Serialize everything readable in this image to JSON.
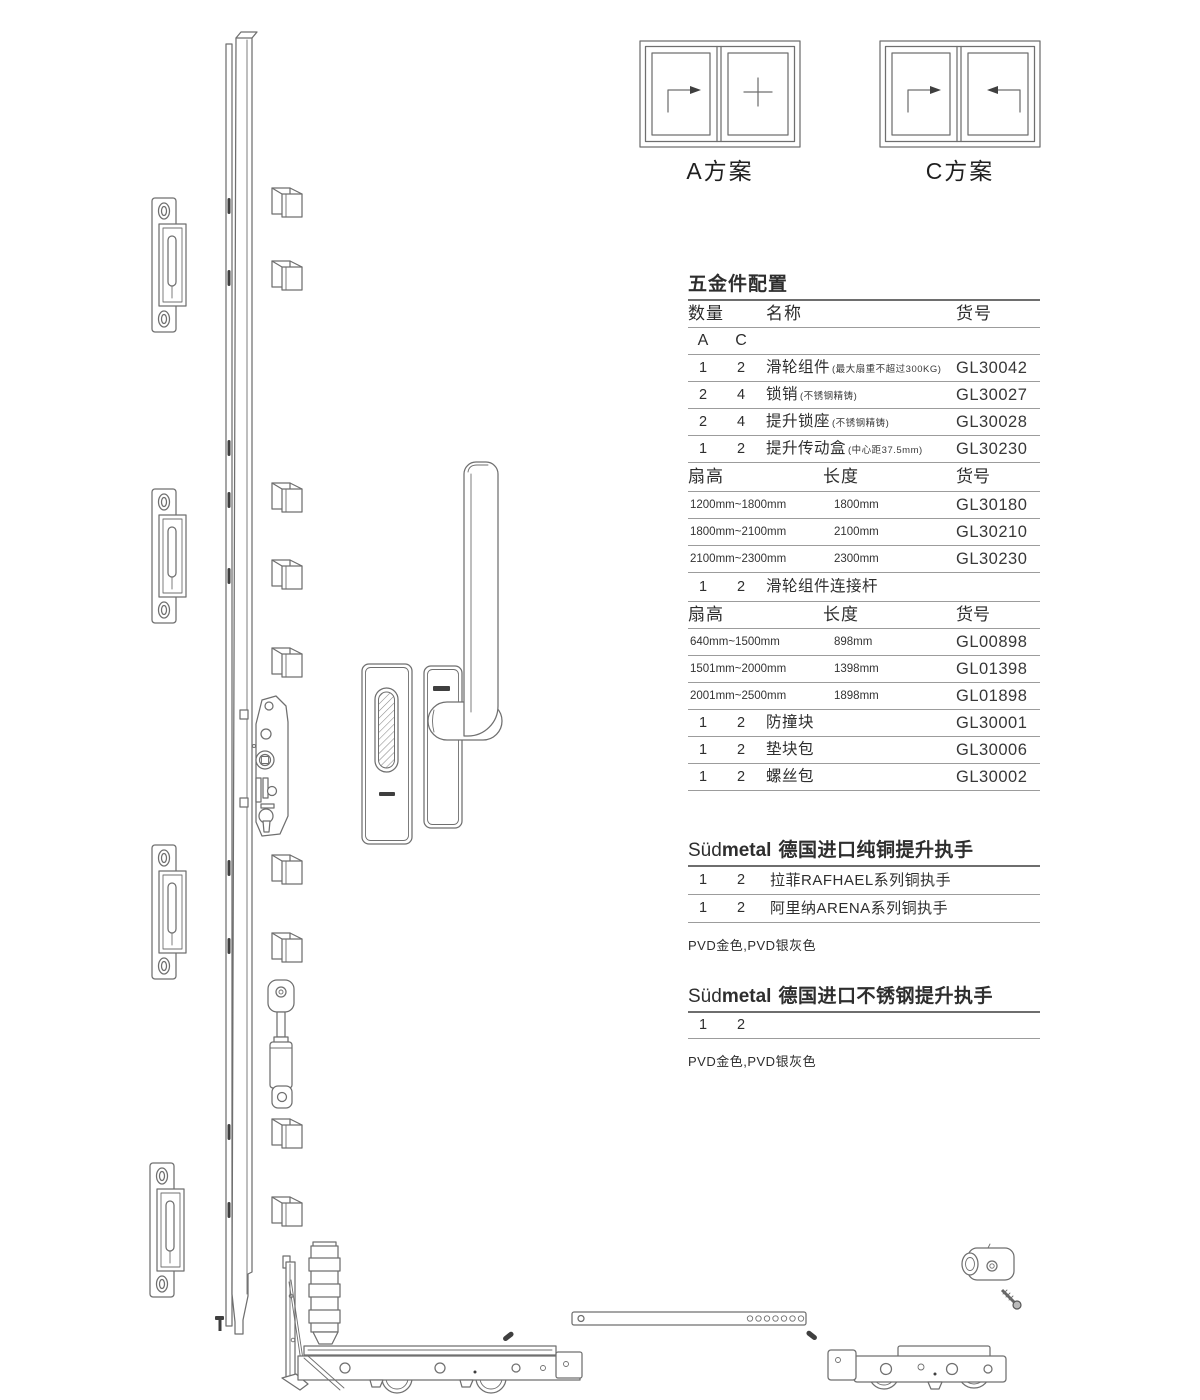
{
  "plans": {
    "a_label": "A方案",
    "c_label": "C方案"
  },
  "hardware": {
    "title": "五金件配置",
    "headers": {
      "qty": "数量",
      "name": "名称",
      "code": "货号"
    },
    "qty_cols": {
      "a": "A",
      "c": "C"
    },
    "rows": [
      {
        "a": "1",
        "c": "2",
        "name": "滑轮组件",
        "note": "(最大扇重不超过300KG)",
        "code": "GL30042"
      },
      {
        "a": "2",
        "c": "4",
        "name": "锁销",
        "note": "(不锈钢精铸)",
        "code": "GL30027"
      },
      {
        "a": "2",
        "c": "4",
        "name": "提升锁座",
        "note": "(不锈钢精铸)",
        "code": "GL30028"
      },
      {
        "a": "1",
        "c": "2",
        "name": "提升传动盒",
        "note": "(中心距37.5mm)",
        "code": "GL30230"
      }
    ],
    "size_header1": {
      "fan": "扇高",
      "len": "长度",
      "code": "货号"
    },
    "size_rows1": [
      {
        "fan": "1200mm~1800mm",
        "len": "1800mm",
        "code": "GL30180"
      },
      {
        "fan": "1800mm~2100mm",
        "len": "2100mm",
        "code": "GL30210"
      },
      {
        "fan": "2100mm~2300mm",
        "len": "2300mm",
        "code": "GL30230"
      }
    ],
    "connector_row": {
      "a": "1",
      "c": "2",
      "name": "滑轮组件连接杆"
    },
    "size_header2": {
      "fan": "扇高",
      "len": "长度",
      "code": "货号"
    },
    "size_rows2": [
      {
        "fan": "640mm~1500mm",
        "len": "898mm",
        "code": "GL00898"
      },
      {
        "fan": "1501mm~2000mm",
        "len": "1398mm",
        "code": "GL01398"
      },
      {
        "fan": "2001mm~2500mm",
        "len": "1898mm",
        "code": "GL01898"
      }
    ],
    "tail_rows": [
      {
        "a": "1",
        "c": "2",
        "name": "防撞块",
        "code": "GL30001"
      },
      {
        "a": "1",
        "c": "2",
        "name": "垫块包",
        "code": "GL30006"
      },
      {
        "a": "1",
        "c": "2",
        "name": "螺丝包",
        "code": "GL30002"
      }
    ]
  },
  "brass_section": {
    "brand_light": "Süd",
    "brand_bold": "metal",
    "title": "德国进口纯铜提升执手",
    "rows": [
      {
        "a": "1",
        "c": "2",
        "name": "拉菲RAFHAEL系列铜执手"
      },
      {
        "a": "1",
        "c": "2",
        "name": "阿里纳ARENA系列铜执手"
      }
    ],
    "note": "PVD金色,PVD银灰色"
  },
  "steel_section": {
    "brand_light": "Süd",
    "brand_bold": "metal",
    "title": "德国进口不锈钢提升执手",
    "row": {
      "a": "1",
      "c": "2"
    },
    "note": "PVD金色,PVD银灰色"
  },
  "diagram": {
    "stroke": "#6f6f6f",
    "components": [
      "vertical-lock-rail",
      "lock-keeper-plate",
      "lock-pin-block",
      "lock-gearbox",
      "flat-pull-handle",
      "lift-handle",
      "damper-cylinder",
      "corner-guide",
      "roller-carriage-left",
      "connecting-rod",
      "roller-carriage-right",
      "anti-collision-block",
      "screw",
      "plan-a-window",
      "plan-c-window"
    ]
  }
}
